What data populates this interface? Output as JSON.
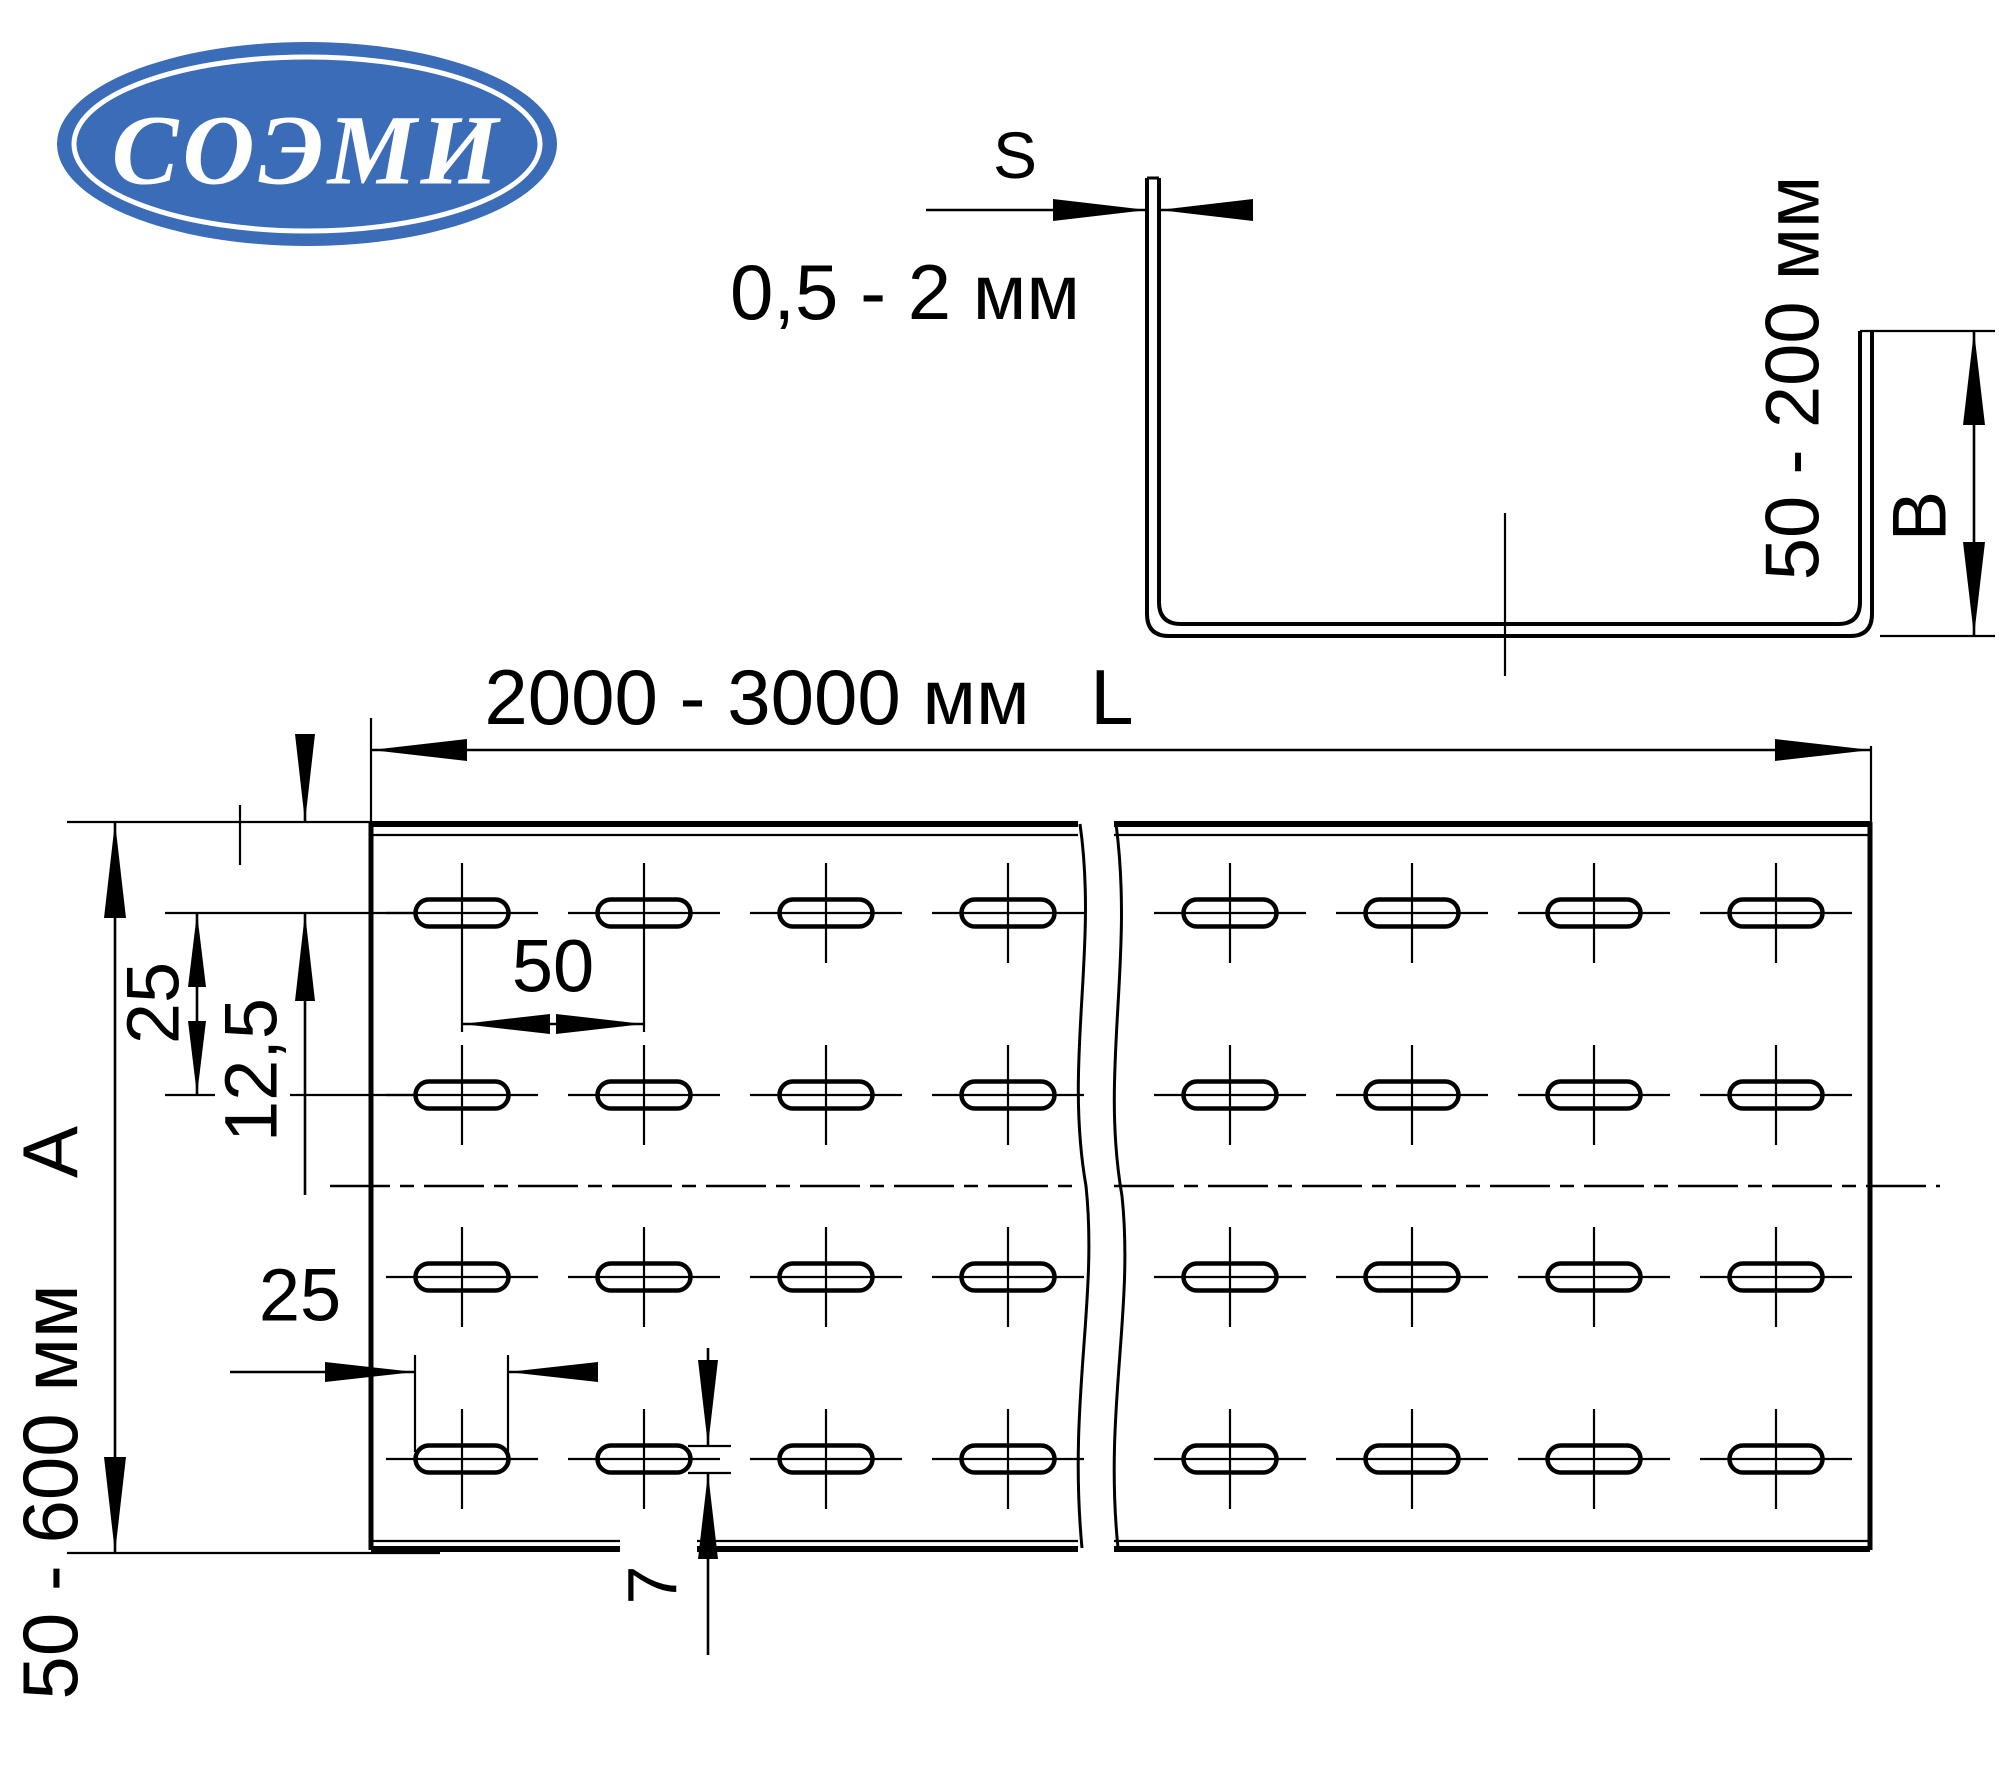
{
  "logo": {
    "text": "СОЭМИ",
    "bg_color": "#3b6cb7",
    "text_color": "#ffffff"
  },
  "profile_view": {
    "thickness_label": "S",
    "thickness_range": "0,5 - 2 мм",
    "height_range": "50 - 200 мм",
    "height_label": "B"
  },
  "plan_view": {
    "length_range": "2000 - 3000 мм",
    "length_label": "L",
    "hole_pitch_horizontal": "50",
    "row_pitch_vertical": "25",
    "first_row_offset": "12,5",
    "width_label": "A",
    "width_range": "50 - 600 мм",
    "hole_length": "25",
    "hole_width": "7"
  }
}
